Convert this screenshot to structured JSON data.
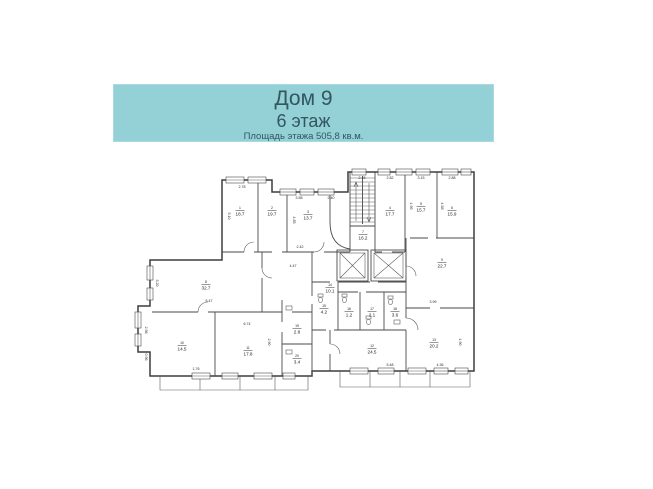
{
  "header": {
    "title": "Дом 9",
    "subtitle": "6 этаж",
    "area_note": "Площадь этажа 505,8 кв.м.",
    "colors": {
      "background": "#93d1d6",
      "text": "#33565f"
    }
  },
  "plan": {
    "line_color": "#3d3d3d",
    "rooms": [
      {
        "num": "1",
        "area": "18.7",
        "x": 240,
        "y": 212
      },
      {
        "num": "2",
        "area": "19.7",
        "x": 272,
        "y": 212
      },
      {
        "num": "3",
        "area": "13.7",
        "x": 308,
        "y": 216
      },
      {
        "num": "4",
        "area": "17.7",
        "x": 390,
        "y": 212
      },
      {
        "num": "5",
        "area": "15.7",
        "x": 421,
        "y": 208
      },
      {
        "num": "6",
        "area": "15.9",
        "x": 452,
        "y": 212
      },
      {
        "num": "7",
        "area": "16.2",
        "x": 363,
        "y": 236
      },
      {
        "num": "8",
        "area": "32.7",
        "x": 206,
        "y": 286
      },
      {
        "num": "9",
        "area": "22.7",
        "x": 442,
        "y": 264
      },
      {
        "num": "10",
        "area": "14.5",
        "x": 182,
        "y": 347
      },
      {
        "num": "11",
        "area": "17.8",
        "x": 248,
        "y": 352
      },
      {
        "num": "12",
        "area": "24.5",
        "x": 372,
        "y": 350
      },
      {
        "num": "13",
        "area": "20.2",
        "x": 434,
        "y": 344
      },
      {
        "num": "14",
        "area": "10.1",
        "x": 330,
        "y": 289
      },
      {
        "num": "15",
        "area": "4.2",
        "x": 324,
        "y": 310
      },
      {
        "num": "16",
        "area": "1.2",
        "x": 349,
        "y": 313
      },
      {
        "num": "17",
        "area": "2.1",
        "x": 372,
        "y": 313
      },
      {
        "num": "18",
        "area": "3.6",
        "x": 395,
        "y": 313
      },
      {
        "num": "19",
        "area": "2.8",
        "x": 297,
        "y": 330
      },
      {
        "num": "20",
        "area": "3.4",
        "x": 297,
        "y": 360
      }
    ],
    "dimensions": [
      {
        "text": "2.78",
        "x": 242,
        "y": 188,
        "rotate": 0
      },
      {
        "text": "3.58",
        "x": 299,
        "y": 199,
        "rotate": 0
      },
      {
        "text": "2.40",
        "x": 331,
        "y": 199,
        "rotate": 0
      },
      {
        "text": "2.45",
        "x": 362,
        "y": 179,
        "rotate": 0
      },
      {
        "text": "2.82",
        "x": 390,
        "y": 179,
        "rotate": 0
      },
      {
        "text": "3.15",
        "x": 421,
        "y": 179,
        "rotate": 0
      },
      {
        "text": "2.88",
        "x": 452,
        "y": 179,
        "rotate": 0
      },
      {
        "text": "5.10",
        "x": 228,
        "y": 216,
        "rotate": 90
      },
      {
        "text": "4.85",
        "x": 293,
        "y": 220,
        "rotate": 90
      },
      {
        "text": "4.95",
        "x": 410,
        "y": 206,
        "rotate": 90
      },
      {
        "text": "4.58",
        "x": 441,
        "y": 206,
        "rotate": 90
      },
      {
        "text": "3.20",
        "x": 156,
        "y": 283,
        "rotate": 90
      },
      {
        "text": "2.98",
        "x": 145,
        "y": 330,
        "rotate": 90
      },
      {
        "text": "0.96",
        "x": 145,
        "y": 357,
        "rotate": 90
      },
      {
        "text": "2.42",
        "x": 300,
        "y": 248,
        "rotate": 0
      },
      {
        "text": "4.47",
        "x": 293,
        "y": 267,
        "rotate": 0
      },
      {
        "text": "6.47",
        "x": 209,
        "y": 302,
        "rotate": 0
      },
      {
        "text": "6.74",
        "x": 247,
        "y": 325,
        "rotate": 0
      },
      {
        "text": "3.99",
        "x": 433,
        "y": 303,
        "rotate": 0
      },
      {
        "text": "4.90",
        "x": 459,
        "y": 342,
        "rotate": 90
      },
      {
        "text": "2.90",
        "x": 268,
        "y": 342,
        "rotate": 90
      },
      {
        "text": "1.76",
        "x": 196,
        "y": 370,
        "rotate": 0
      },
      {
        "text": "5.48",
        "x": 390,
        "y": 366,
        "rotate": 0
      },
      {
        "text": "4.36",
        "x": 440,
        "y": 366,
        "rotate": 0
      }
    ]
  }
}
